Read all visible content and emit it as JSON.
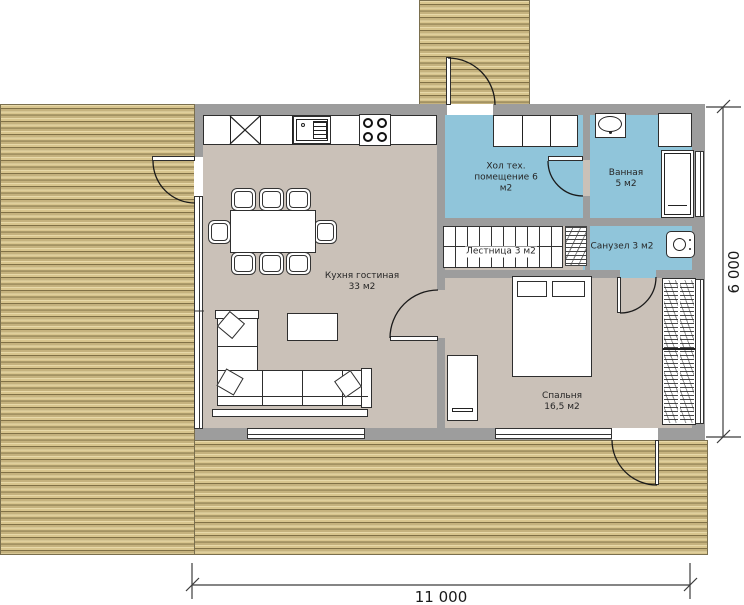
{
  "rooms": {
    "kitchen_living": {
      "line1": "Кухня гостиная",
      "line2": "33 м2"
    },
    "hall_tech": {
      "line1": "Хол тех.",
      "line2": "помещение 6",
      "line3": "м2"
    },
    "bathroom": {
      "line1": "Ванная",
      "line2": "5 м2"
    },
    "stairs": {
      "line1": "Лестница 3 м2"
    },
    "wc": {
      "line1": "Санузел 3 м2"
    },
    "bedroom": {
      "line1": "Спальня",
      "line2": "16,5 м2"
    }
  },
  "dimensions": {
    "width": "11 000",
    "height": "6 000"
  },
  "colors": {
    "deck_fill": "#d8c58e",
    "wall_fill": "#9d9d9d",
    "floor_fill": "#cac1b8",
    "wet_room_fill": "#90c5da"
  }
}
